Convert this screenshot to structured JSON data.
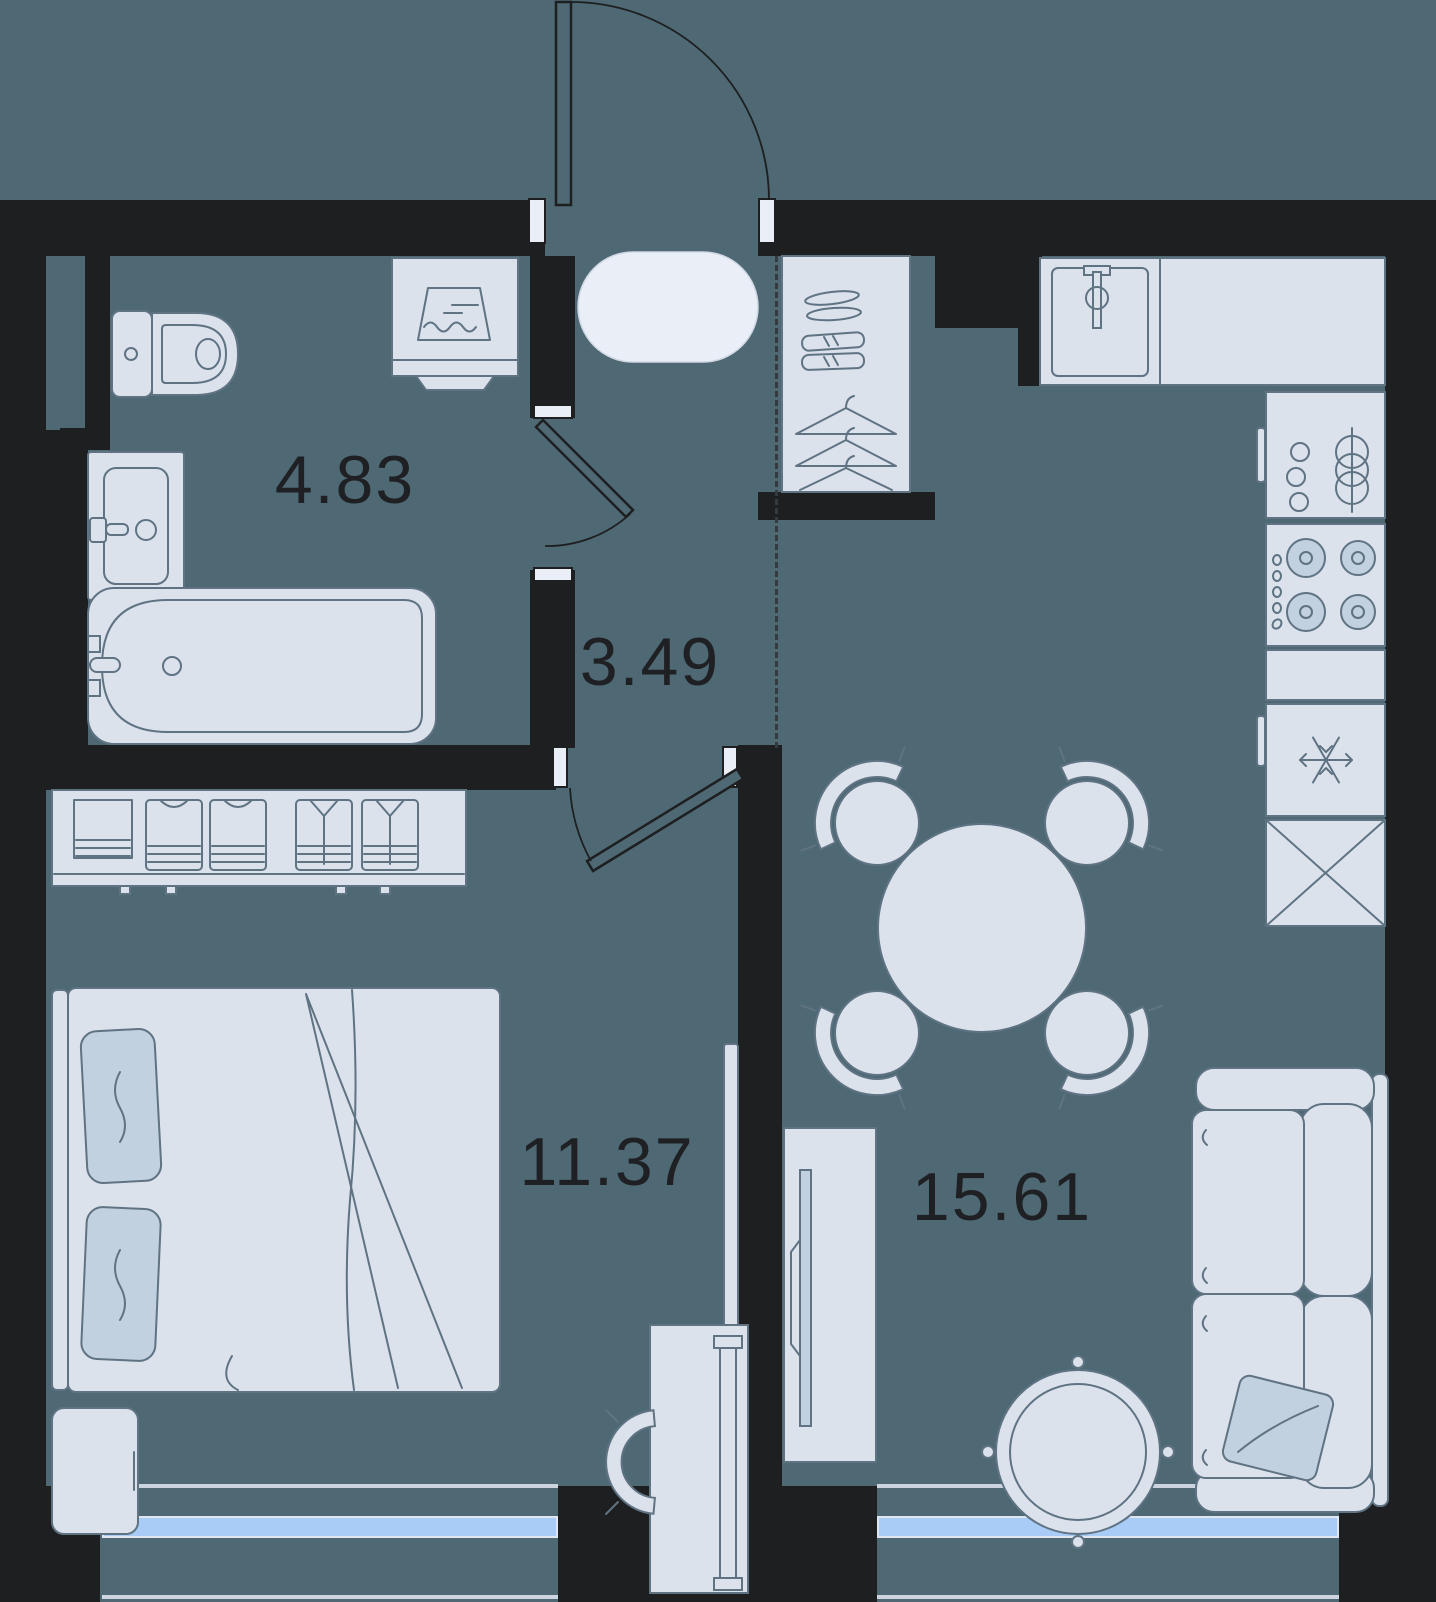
{
  "theme": {
    "bg": "#4e6974",
    "wall": "#1e1f21",
    "fill": "#dbe2ec",
    "fill_light": "#e9eef7",
    "accent_soft": "#c2d1df",
    "stroke": "#5f7383",
    "sill": "#ccd5df",
    "window_glass": "#a9ccf7",
    "window_frame": "#dfe6ef",
    "mat_edge": "#cfd7e3",
    "dash": "#333a40",
    "label": "#1f2023"
  },
  "rooms": [
    {
      "name": "bathroom",
      "area": "4.83"
    },
    {
      "name": "hallway",
      "area": "3.49"
    },
    {
      "name": "bedroom",
      "area": "11.37"
    },
    {
      "name": "living-kitchen",
      "area": "15.61"
    }
  ],
  "furniture": {
    "bathroom": [
      "toilet",
      "washing-machine",
      "sink",
      "bathtub"
    ],
    "hallway": [
      "entry-mat",
      "shoe-wardrobe",
      "hangers"
    ],
    "kitchen": [
      "sink",
      "countertop",
      "cookware-shelf",
      "stove",
      "fridge",
      "storage-cabinet"
    ],
    "living": [
      "dining-table",
      "chairs",
      "tv-stand",
      "tv",
      "round-rug",
      "sofa",
      "pillow"
    ],
    "bedroom": [
      "dresser",
      "bed",
      "pillows",
      "nightstand",
      "wall-tv",
      "desk",
      "desk-chair",
      "radiator"
    ]
  },
  "windows": {
    "count": 2,
    "glass_color": "#a9ccf7"
  },
  "doors": {
    "entrance": "top-center",
    "bathroom": "hallway-side",
    "bedroom": "hallway-side"
  }
}
